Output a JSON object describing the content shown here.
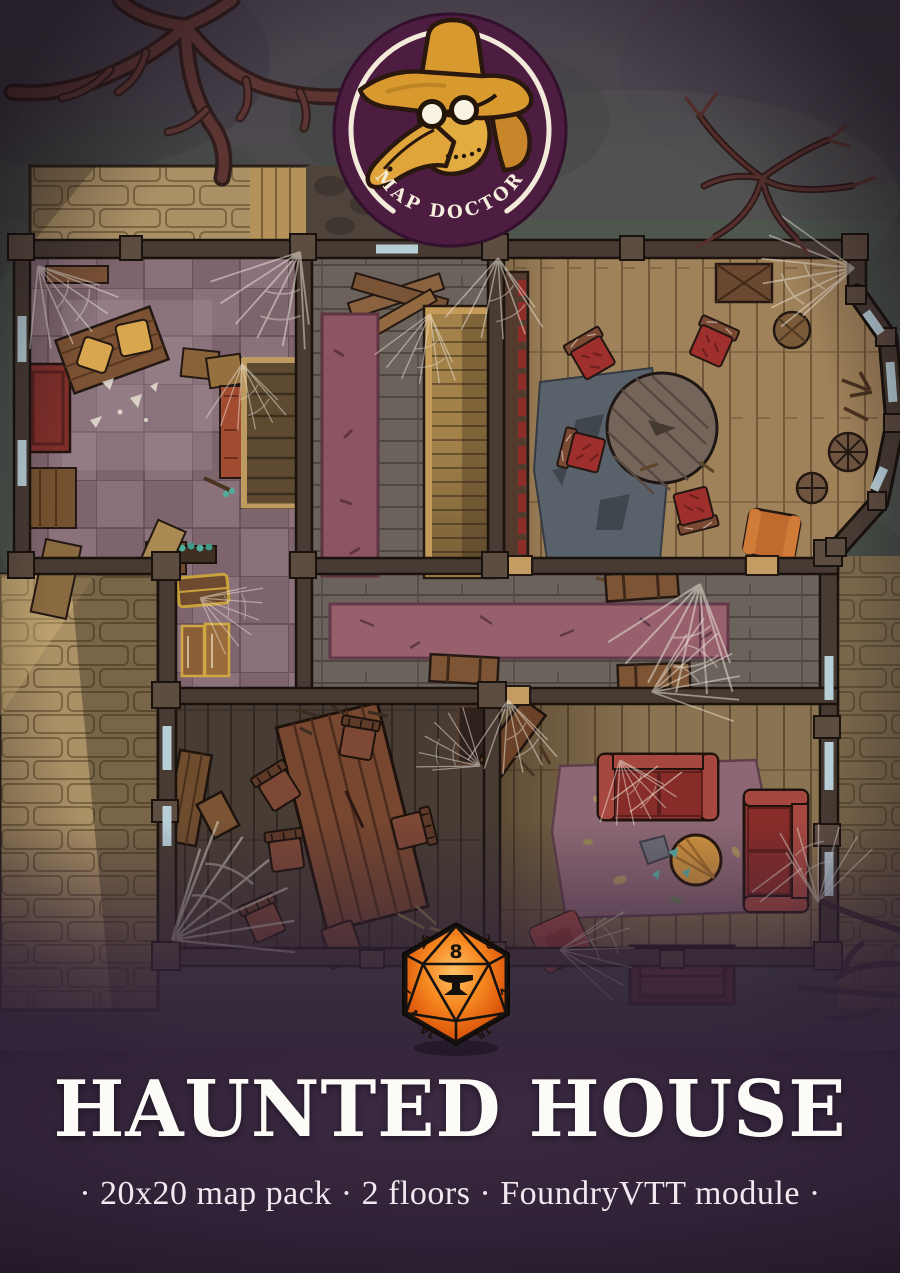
{
  "branding": {
    "logo_text": "MAP DOCTOR",
    "logo_icon": "plague-doctor-mask"
  },
  "cover": {
    "title": "HAUNTED HOUSE",
    "subtitle": "· 20x20 map pack · 2 floors · FoundryVTT module ·"
  },
  "d20": {
    "icon": "d20-anvil",
    "numbers": {
      "top": "8",
      "upper_right": "20",
      "right": "2",
      "lower_right": "18",
      "lower_left": "14",
      "left": "7",
      "upper_left": "16",
      "far_left": "4"
    }
  },
  "colors": {
    "badge_purple": "#4c1c41",
    "ring_white": "#f3ead9",
    "doctor_gold": "#d89a2e",
    "dice_orange": "#f2761b",
    "ground_moss": "#49504a",
    "porch_stone": "#ab9166",
    "wall_brown": "#473b33",
    "tile_mauve": "#8b7179",
    "wood_tan": "#a0825a",
    "rug_maroon": "#8d5564",
    "rug_rose": "#8d6874",
    "sofa_red": "#93362f",
    "bottom_purple": "#32233a",
    "title_white": "#fdfbf7"
  }
}
